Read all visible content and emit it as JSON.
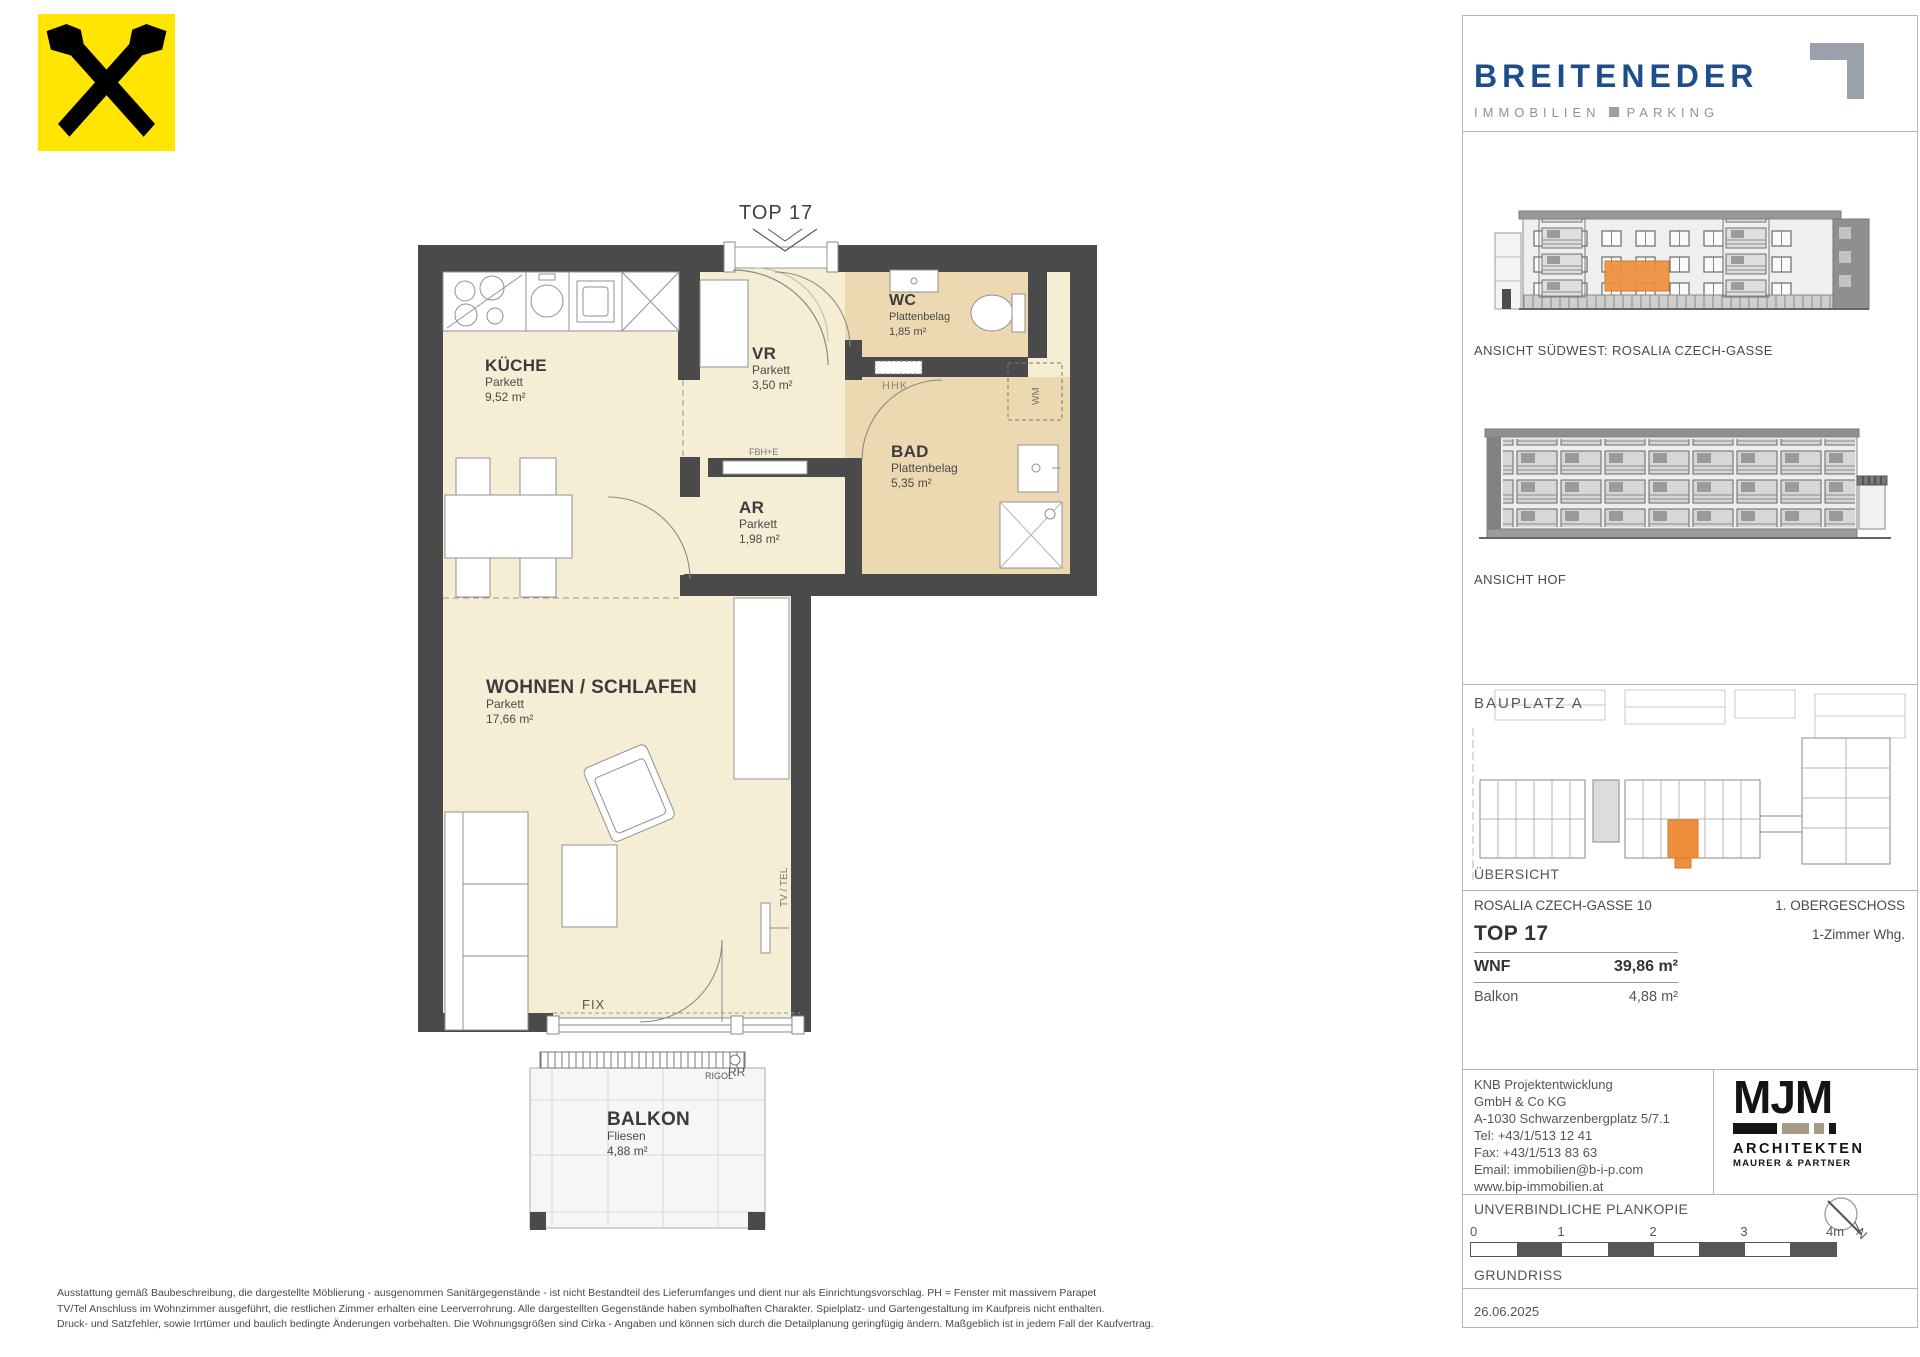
{
  "branding": {
    "breiteneder": {
      "name": "BREITENEDER",
      "tagline_immobilien": "IMMOBILIEN",
      "tagline_parking": "PARKING",
      "brand_blue": "#1d4e89"
    },
    "raiffeisen_yellow": "#ffe500"
  },
  "plan": {
    "unit_label": "TOP 17",
    "rooms": [
      {
        "name": "KÜCHE",
        "material": "Parkett",
        "area": "9,52 m²"
      },
      {
        "name": "VR",
        "material": "Parkett",
        "area": "3,50 m²"
      },
      {
        "name": "WC",
        "material": "Plattenbelag",
        "area": "1,85 m²"
      },
      {
        "name": "BAD",
        "material": "Plattenbelag",
        "area": "5,35 m²"
      },
      {
        "name": "AR",
        "material": "Parkett",
        "area": "1,98 m²"
      },
      {
        "name": "WOHNEN / SCHLAFEN",
        "material": "Parkett",
        "area": "17,66 m²"
      },
      {
        "name": "BALKON",
        "material": "Fliesen",
        "area": "4,88 m²"
      }
    ],
    "annotations": {
      "hhk": "HHK",
      "fbhe": "FBH+E",
      "wm": "WM",
      "tv_tel": "TV / TEL",
      "fix": "FIX",
      "rigol": "RIGOL",
      "rr": "RR"
    },
    "colors": {
      "wall_dark": "#4a4a4a",
      "floor_cream": "#f6edd5",
      "floor_tile": "#ecd9b2",
      "highlight_orange": "#ee8f3e"
    }
  },
  "sidebar": {
    "elevation_southwest_label": "ANSICHT SÜDWEST: ROSALIA CZECH-GASSE",
    "elevation_hof_label": "ANSICHT HOF",
    "siteplan": {
      "bauplatz_label": "BAUPLATZ  A",
      "uebersicht_label": "ÜBERSICHT"
    },
    "info": {
      "address": "ROSALIA CZECH-GASSE 10",
      "floor": "1. OBERGESCHOSS",
      "unit": "TOP 17",
      "unit_type": "1-Zimmer Whg.",
      "wnf_label": "WNF",
      "wnf_value": "39,86 m²",
      "balkon_label": "Balkon",
      "balkon_value": "4,88 m²"
    },
    "developer": {
      "lines": [
        "KNB Projektentwicklung",
        "GmbH & Co KG",
        "A-1030 Schwarzenbergplatz 5/7.1",
        "Tel: +43/1/513 12 41",
        "Fax: +43/1/513 83 63",
        "Email: immobilien@b-i-p.com",
        "www.bip-immobilien.at"
      ]
    },
    "architect": {
      "name": "MJM",
      "line1": "ARCHITEKTEN",
      "line2": "MAURER & PARTNER"
    },
    "plankopie": "UNVERBINDLICHE PLANKOPIE",
    "north_label": "N",
    "scale_ticks": [
      "0",
      "1",
      "2",
      "3",
      "4m"
    ],
    "drawing_type": "GRUNDRISS",
    "date": "26.06.2025"
  },
  "footer": {
    "lines": [
      "Ausstattung gemäß Baubeschreibung, die dargestellte Möblierung - ausgenommen Sanitärgegenstände - ist nicht Bestandteil des Lieferumfanges und dient nur als Einrichtungsvorschlag. PH = Fenster mit massivem Parapet",
      "TV/Tel Anschluss im Wohnzimmer ausgeführt, die restlichen Zimmer erhalten eine Leerverrohrung. Alle dargestellten Gegenstände haben symbolhaften Charakter. Spielplatz- und Gartengestaltung im Kaufpreis nicht enthalten.",
      "Druck- und Satzfehler, sowie Irrtümer und baulich bedingte Änderungen vorbehalten. Die Wohnungsgrößen sind Cirka - Angaben und können sich durch die Detailplanung geringfügig ändern. Maßgeblich ist in jedem Fall der Kaufvertrag."
    ]
  }
}
